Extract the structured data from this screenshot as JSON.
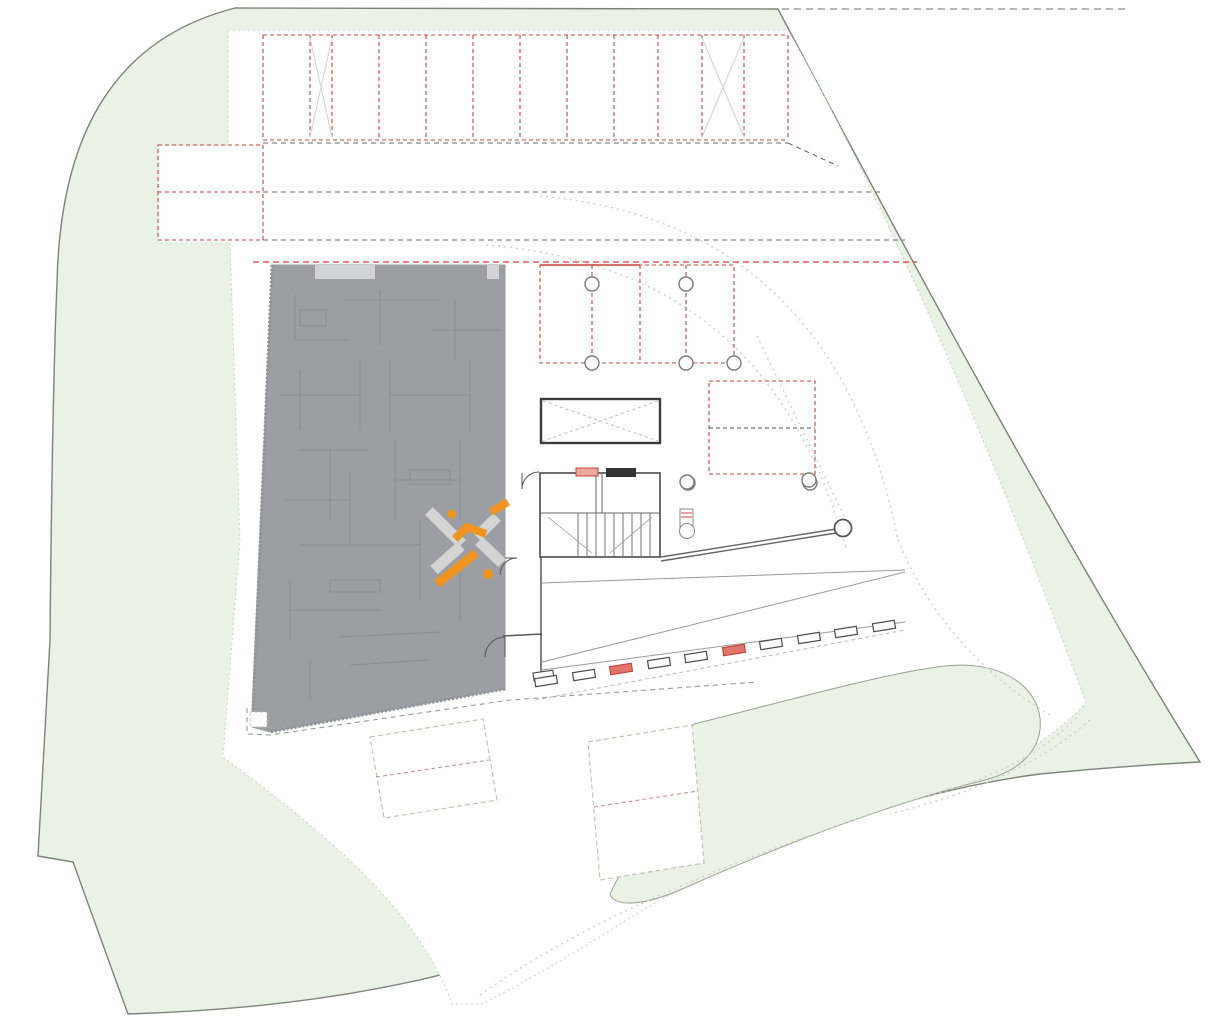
{
  "drawing": {
    "type": "architectural-site-plan-ground-floor",
    "colors": {
      "landscape_green": "#eaf1e5",
      "site_border": "#7d837a",
      "building_gray": "#9b9ea3",
      "building_inner_line": "#8a8d92",
      "parking_red_dash": "#c4453d",
      "lane_dark_dash": "#686868",
      "property_red_line": "#cd3d37",
      "guide_dotted": "#ccd2c8",
      "future_bay_dash": "#c7bcb4",
      "future_bay_midline": "#c08b84",
      "wheelstop_stroke": "#4a4a4a",
      "wheelstop_red_fill": "#e2756b",
      "core_line": "#4a4a4a",
      "watermark_orange": "#f2941d",
      "watermark_gray": "#d6d6d6"
    },
    "parking": {
      "top_row": {
        "y1": 35,
        "y2": 140,
        "x_start": 263,
        "x_end": 788,
        "stall_lines_x": [
          263,
          310,
          332,
          379,
          426,
          473,
          520,
          567,
          614,
          658,
          702,
          744,
          788
        ],
        "x_marked_stalls": [
          [
            310,
            332
          ],
          [
            702,
            744
          ]
        ],
        "stall_count": 12
      },
      "left_bay": {
        "x": 158,
        "y": 145,
        "w": 105,
        "h": 95,
        "midline_y": 192,
        "spaces": 2
      },
      "canopy_bay": {
        "x": 540,
        "y": 265,
        "w": 194,
        "h": 98,
        "dividers_x": [
          592,
          640,
          686
        ],
        "posts": [
          [
            592,
            284
          ],
          [
            686,
            284
          ],
          [
            592,
            363
          ],
          [
            686,
            363
          ],
          [
            734,
            363
          ]
        ],
        "post_radius": 7
      },
      "court_bay": {
        "x": 709,
        "y": 381,
        "w": 106,
        "h": 93,
        "midline_y": 428,
        "posts": [
          [
            688,
            483
          ],
          [
            810,
            483
          ]
        ],
        "post_radius": 7
      },
      "future_bays": [
        {
          "points": "370,737 483,719 497,800 384,818",
          "midline": [
            376,
            777,
            489,
            760
          ]
        },
        {
          "points": "588,742 692,725 704,863 600,880",
          "midline": [
            594,
            807,
            698,
            791
          ]
        }
      ],
      "wheel_stops": {
        "centers": [
          [
            546,
            681
          ],
          [
            584,
            675
          ],
          [
            621,
            669
          ],
          [
            659,
            663
          ],
          [
            696,
            657
          ],
          [
            734,
            650
          ],
          [
            771,
            644
          ],
          [
            809,
            638
          ],
          [
            846,
            632
          ],
          [
            884,
            626
          ]
        ],
        "red_indices": [
          2,
          5
        ],
        "w": 22,
        "h": 8,
        "angle": -9
      }
    },
    "core": {
      "stair_box": {
        "x": 540,
        "y": 473,
        "w": 120,
        "h": 84
      },
      "shaft_box": {
        "x": 541,
        "y": 399,
        "w": 119,
        "h": 44
      },
      "tread_xs": [
        578,
        587,
        596,
        605,
        614,
        623,
        632,
        641,
        650
      ],
      "landing_y": 513
    },
    "barrier": {
      "arm": [
        661,
        559,
        836,
        531
      ],
      "pivot": [
        843,
        528
      ],
      "pivot_r": 8.5,
      "machine": {
        "x": 680,
        "y": 509,
        "w": 13,
        "h": 20
      }
    },
    "columns": [
      [
        687,
        482
      ],
      [
        809,
        480
      ]
    ],
    "watermark": {
      "center": [
        468,
        543
      ]
    }
  }
}
